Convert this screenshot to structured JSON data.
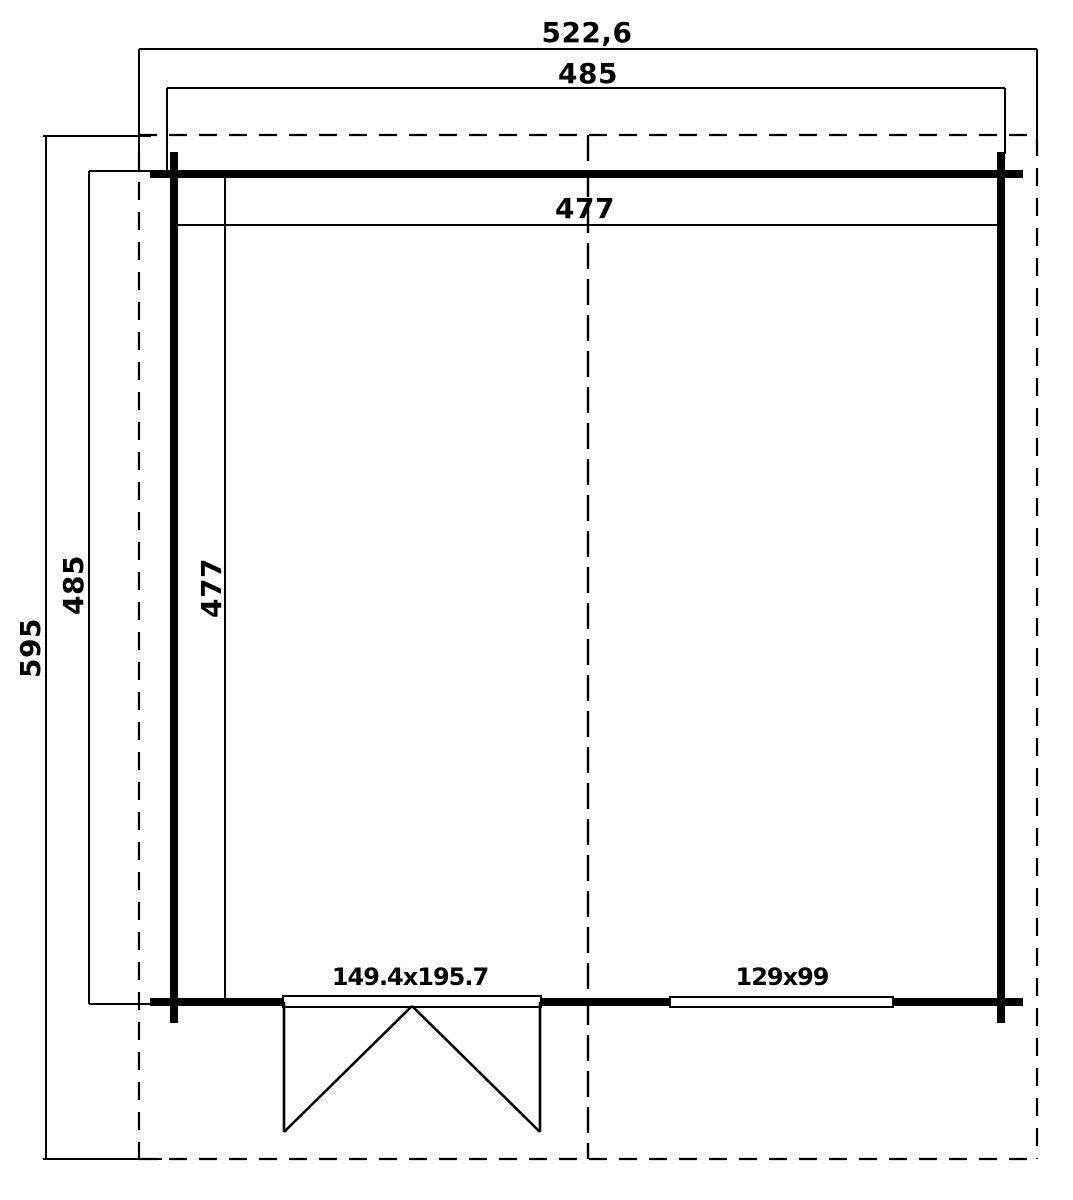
{
  "page": {
    "width": 1073,
    "height": 1200,
    "background": "#ffffff",
    "line_color": "#000000",
    "text_color": "#000000"
  },
  "plan": {
    "labels": {
      "overall_width": {
        "text": "522,6",
        "x": 587,
        "y": 33,
        "rotate": 0
      },
      "outer_width": {
        "text": "485",
        "x": 588,
        "y": 74,
        "rotate": 0
      },
      "inner_width": {
        "text": "477",
        "x": 585,
        "y": 209,
        "rotate": 0
      },
      "overall_depth": {
        "text": "595",
        "x": 31,
        "y": 648,
        "rotate": -90
      },
      "outer_depth": {
        "text": "485",
        "x": 74,
        "y": 585,
        "rotate": -90
      },
      "inner_depth": {
        "text": "477",
        "x": 212,
        "y": 588,
        "rotate": -90
      },
      "door_size": {
        "text": "149.4x195.7",
        "x": 410,
        "y": 977,
        "rotate": 0
      },
      "window_size": {
        "text": "129x99",
        "x": 782,
        "y": 977,
        "rotate": 0
      }
    },
    "shapes": [
      {
        "kind": "line",
        "name": "dimension-line-overall-width",
        "x1": 139,
        "y1": 49,
        "x2": 1037,
        "y2": 49,
        "w": 2
      },
      {
        "kind": "line",
        "name": "extension-overall-width-left",
        "x1": 139,
        "y1": 49,
        "x2": 139,
        "y2": 152,
        "w": 2
      },
      {
        "kind": "line",
        "name": "extension-overall-width-right",
        "x1": 1037,
        "y1": 49,
        "x2": 1037,
        "y2": 138,
        "w": 2
      },
      {
        "kind": "line",
        "name": "dimension-line-outer-width",
        "x1": 167,
        "y1": 88,
        "x2": 1005,
        "y2": 88,
        "w": 2
      },
      {
        "kind": "line",
        "name": "extension-outer-width-left",
        "x1": 167,
        "y1": 88,
        "x2": 167,
        "y2": 172,
        "w": 2
      },
      {
        "kind": "line",
        "name": "extension-outer-width-right",
        "x1": 1005,
        "y1": 88,
        "x2": 1005,
        "y2": 154,
        "w": 2
      },
      {
        "kind": "line",
        "name": "dimension-line-overall-depth",
        "x1": 46,
        "y1": 136,
        "x2": 46,
        "y2": 1159,
        "w": 2
      },
      {
        "kind": "line",
        "name": "extension-overall-depth-top",
        "x1": 43,
        "y1": 136,
        "x2": 151,
        "y2": 136,
        "w": 2
      },
      {
        "kind": "line",
        "name": "extension-overall-depth-bottom",
        "x1": 43,
        "y1": 1159,
        "x2": 162,
        "y2": 1159,
        "w": 2
      },
      {
        "kind": "line",
        "name": "dimension-line-outer-depth",
        "x1": 89,
        "y1": 171,
        "x2": 89,
        "y2": 1004,
        "w": 2
      },
      {
        "kind": "line",
        "name": "extension-outer-depth-top",
        "x1": 89,
        "y1": 171,
        "x2": 154,
        "y2": 171,
        "w": 2
      },
      {
        "kind": "line",
        "name": "extension-outer-depth-bottom",
        "x1": 89,
        "y1": 1004,
        "x2": 154,
        "y2": 1004,
        "w": 2
      },
      {
        "kind": "line",
        "name": "dimension-line-inner-width",
        "x1": 176,
        "y1": 225,
        "x2": 997,
        "y2": 225,
        "w": 2
      },
      {
        "kind": "line",
        "name": "dimension-line-inner-depth",
        "x1": 225,
        "y1": 178,
        "x2": 225,
        "y2": 998,
        "w": 2
      },
      {
        "kind": "line",
        "name": "roof-overhang-outline-top",
        "x1": 139,
        "y1": 135,
        "x2": 1037,
        "y2": 135,
        "w": 2.2,
        "dash": "18,12"
      },
      {
        "kind": "line",
        "name": "roof-overhang-outline-bottom",
        "x1": 139,
        "y1": 1159,
        "x2": 1037,
        "y2": 1159,
        "w": 2.2,
        "dash": "18,12"
      },
      {
        "kind": "line",
        "name": "roof-overhang-outline-left",
        "x1": 139,
        "y1": 152,
        "x2": 139,
        "y2": 1159,
        "w": 2.2,
        "dash": "18,12"
      },
      {
        "kind": "line",
        "name": "roof-overhang-outline-right",
        "x1": 1037,
        "y1": 138,
        "x2": 1037,
        "y2": 1159,
        "w": 2.2,
        "dash": "18,12"
      },
      {
        "kind": "line",
        "name": "ridge-center-line",
        "x1": 588,
        "y1": 135,
        "x2": 588,
        "y2": 1159,
        "w": 2.4,
        "dash": "26,10"
      },
      {
        "kind": "line",
        "name": "wall-top",
        "x1": 150,
        "y1": 174,
        "x2": 1023,
        "y2": 174,
        "w": 8
      },
      {
        "kind": "line",
        "name": "wall-left",
        "x1": 174,
        "y1": 152,
        "x2": 174,
        "y2": 1023,
        "w": 8
      },
      {
        "kind": "line",
        "name": "wall-right",
        "x1": 1001,
        "y1": 152,
        "x2": 1001,
        "y2": 1023,
        "w": 8
      },
      {
        "kind": "line",
        "name": "wall-bottom",
        "x1": 150,
        "y1": 1002,
        "x2": 1023,
        "y2": 1002,
        "w": 8
      },
      {
        "kind": "rect",
        "name": "door-sill",
        "x": 283,
        "y": 996,
        "w": 258,
        "h": 11,
        "sw": 2
      },
      {
        "kind": "rect",
        "name": "window-opening",
        "x": 670,
        "y": 997,
        "w": 223,
        "h": 10,
        "sw": 2
      },
      {
        "kind": "line",
        "name": "door-left-jamb",
        "x1": 284,
        "y1": 1002,
        "x2": 284,
        "y2": 1132,
        "w": 2.6
      },
      {
        "kind": "line",
        "name": "door-left-leaf",
        "x1": 412,
        "y1": 1006,
        "x2": 284,
        "y2": 1132,
        "w": 2.6
      },
      {
        "kind": "line",
        "name": "door-right-jamb",
        "x1": 540,
        "y1": 1002,
        "x2": 540,
        "y2": 1132,
        "w": 2.6
      },
      {
        "kind": "line",
        "name": "door-right-leaf",
        "x1": 412,
        "y1": 1006,
        "x2": 540,
        "y2": 1132,
        "w": 2.6
      }
    ]
  }
}
